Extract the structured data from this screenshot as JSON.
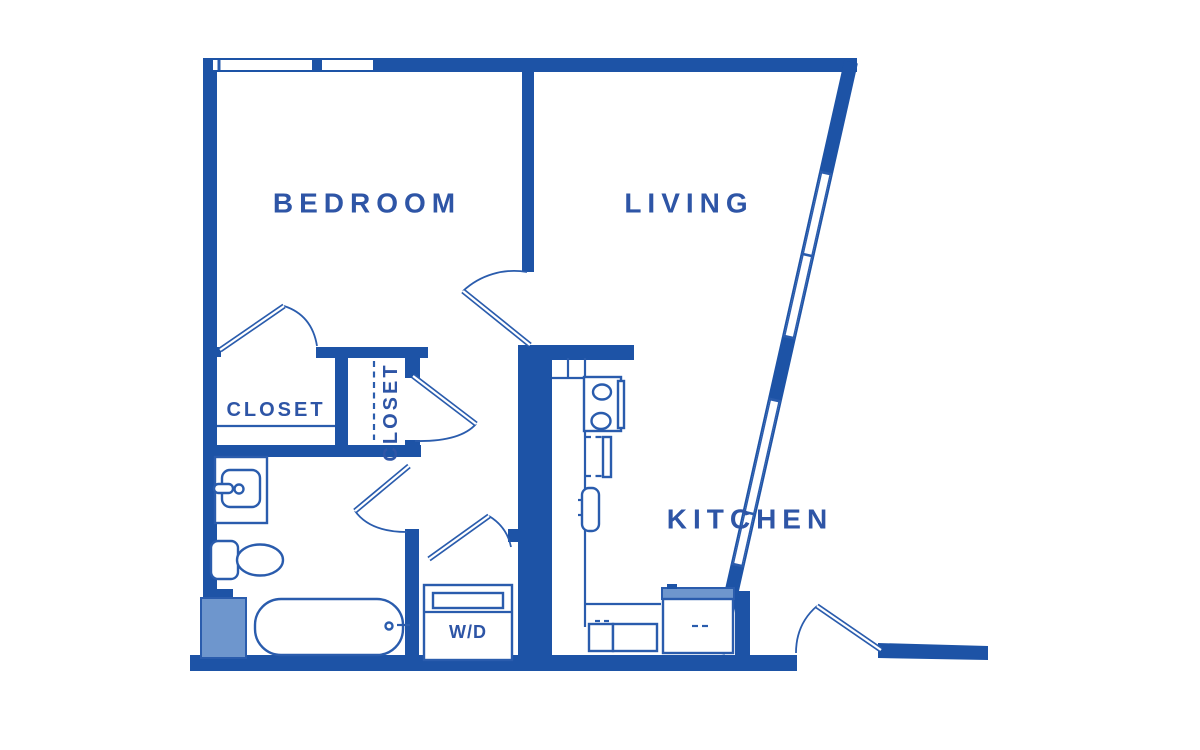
{
  "title": "One-bedroom apartment floor plan",
  "colors": {
    "wall": "#1d53a6",
    "line": "#2a5cad",
    "light_fill": "#6e96cd",
    "label": "#2e55a6",
    "background": "#ffffff"
  },
  "rooms": {
    "bedroom": "BEDROOM",
    "living": "LIVING",
    "kitchen": "KITCHEN",
    "closet_bedroom": "CLOSET",
    "closet_hall": "CLOSET",
    "washer_dryer": "W/D"
  },
  "fixtures": [
    "bathtub",
    "toilet",
    "vanity-sink",
    "shower-shaft",
    "range-stove",
    "dishwasher",
    "kitchen-sink",
    "refrigerator",
    "washer-dryer-unit"
  ],
  "doors": [
    "bedroom-entry-door",
    "bedroom-closet-door",
    "hall-closet-door",
    "bathroom-door",
    "washer-dryer-door",
    "apartment-entry-door"
  ],
  "windows": [
    "bedroom-top-windows",
    "living-slanted-wall-windows"
  ]
}
